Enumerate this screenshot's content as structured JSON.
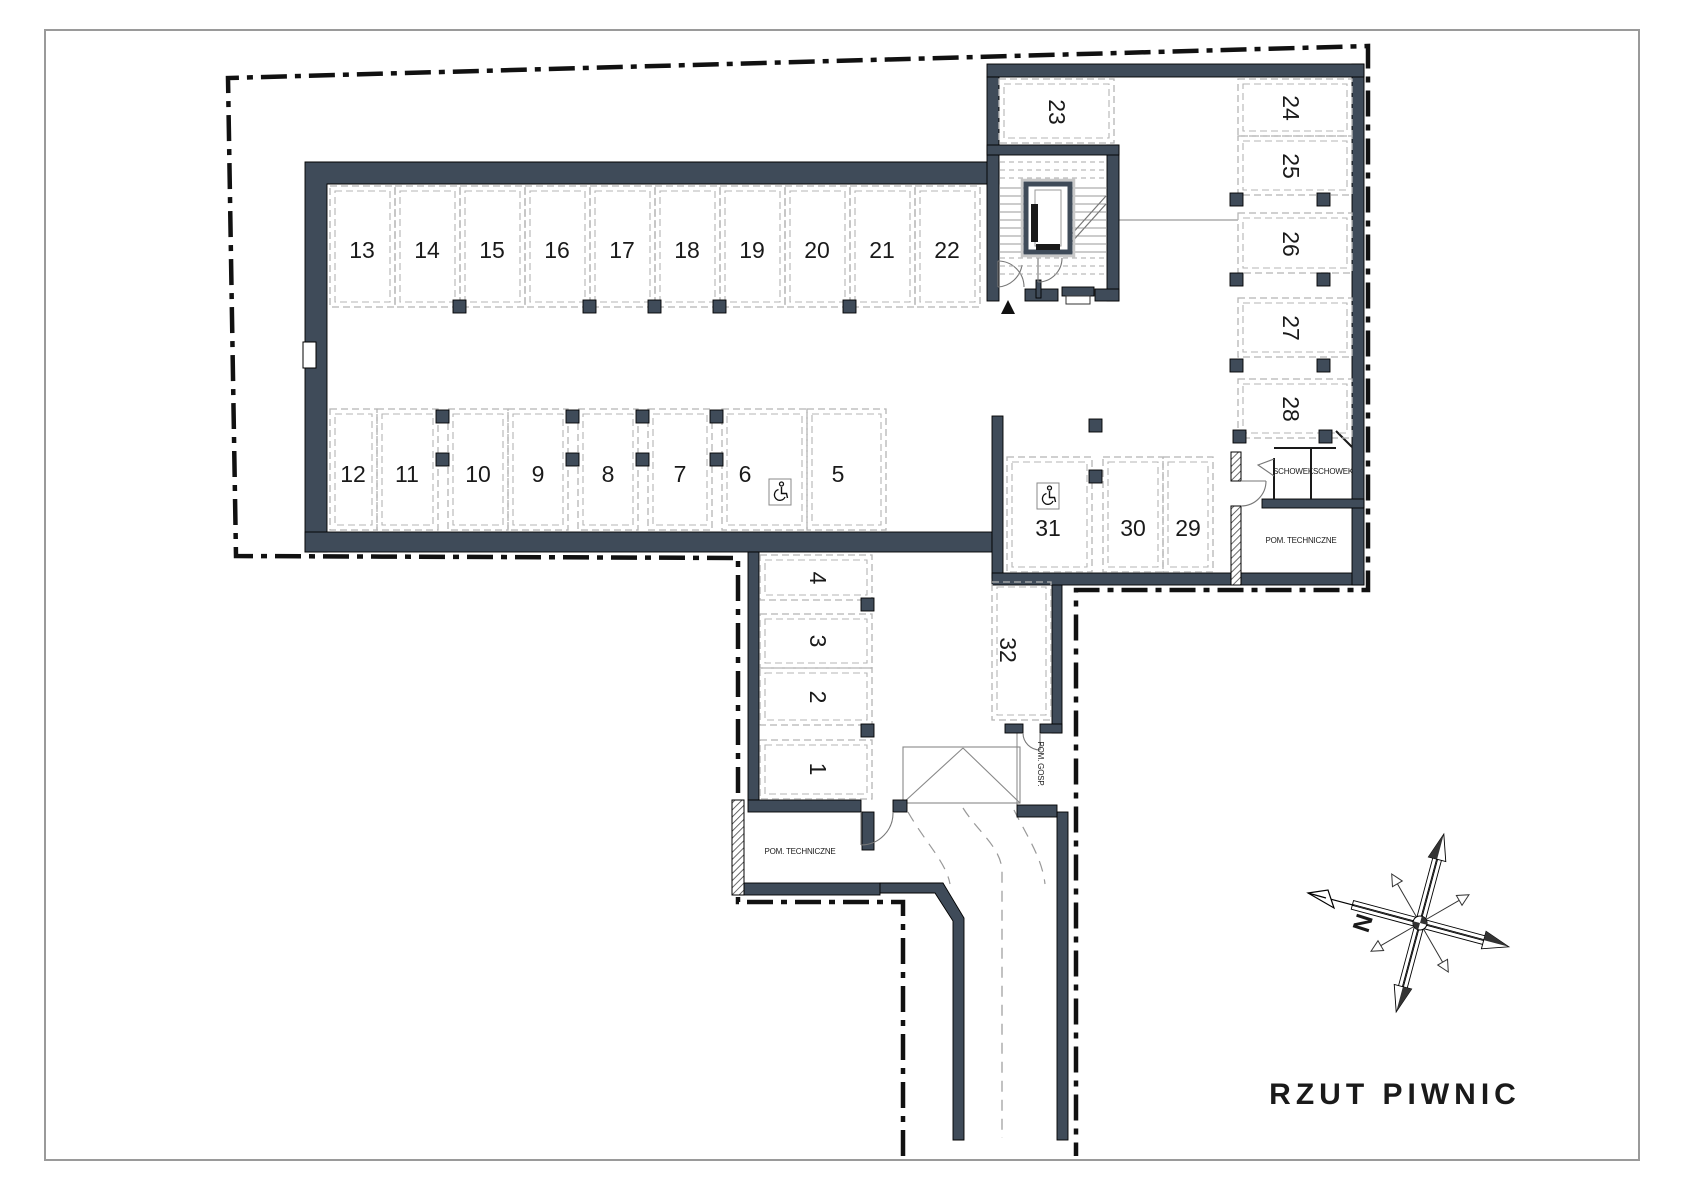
{
  "drawing": {
    "title": "RZUT PIWNIC",
    "compass_north_label": "N"
  },
  "colors": {
    "wall": "#3f4b59",
    "space_dash": "#b5b5b5",
    "boundary": "#111111",
    "stair_line": "#9a9a9a",
    "thin_line": "#888888"
  },
  "spaces": [
    {
      "label": "1"
    },
    {
      "label": "2"
    },
    {
      "label": "3"
    },
    {
      "label": "4"
    },
    {
      "label": "5"
    },
    {
      "label": "6",
      "wheelchair": true
    },
    {
      "label": "7"
    },
    {
      "label": "8"
    },
    {
      "label": "9"
    },
    {
      "label": "10"
    },
    {
      "label": "11"
    },
    {
      "label": "12"
    },
    {
      "label": "13"
    },
    {
      "label": "14"
    },
    {
      "label": "15"
    },
    {
      "label": "16"
    },
    {
      "label": "17"
    },
    {
      "label": "18"
    },
    {
      "label": "19"
    },
    {
      "label": "20"
    },
    {
      "label": "21"
    },
    {
      "label": "22"
    },
    {
      "label": "23"
    },
    {
      "label": "24"
    },
    {
      "label": "25"
    },
    {
      "label": "26"
    },
    {
      "label": "27"
    },
    {
      "label": "28"
    },
    {
      "label": "29"
    },
    {
      "label": "30"
    },
    {
      "label": "31",
      "wheelchair": true
    },
    {
      "label": "32"
    }
  ],
  "rooms": [
    {
      "id": "pom-tech-left",
      "label": "POM. TECHNICZNE"
    },
    {
      "id": "pom-gosp",
      "label": "POM. GOSP."
    },
    {
      "id": "schowek-1",
      "label": "SCHOWEK"
    },
    {
      "id": "schowek-2",
      "label": "SCHOWEK"
    },
    {
      "id": "pom-tech-right",
      "label": "POM. TECHNICZNE"
    }
  ]
}
